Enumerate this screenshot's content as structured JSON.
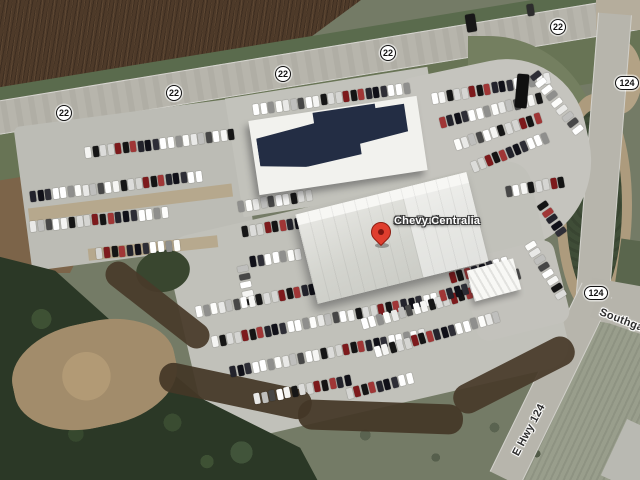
{
  "map": {
    "type": "satellite-view",
    "place": {
      "pin_label_line1": "Jim Butler",
      "pin_label_line2": "Chevy Centralia"
    },
    "road_labels": {
      "route22": "22",
      "route124": "124",
      "e_hwy": "E Hwy 124",
      "southgate": "Southgate"
    },
    "shields_22": [
      {
        "x": 64,
        "y": 113
      },
      {
        "x": 174,
        "y": 93
      },
      {
        "x": 283,
        "y": 74
      },
      {
        "x": 388,
        "y": 53
      },
      {
        "x": 558,
        "y": 27
      }
    ],
    "shields_124": [
      {
        "x": 627,
        "y": 83
      },
      {
        "x": 596,
        "y": 293
      }
    ],
    "colors": {
      "pin_red": "#df3e2e",
      "place_label_text": "#ffffff",
      "road_label_text": "#2e2e2e",
      "road_surface": "#b7b5ac",
      "parking_lot": "#c1c1ba",
      "plowed_field": "#4e3a29",
      "trees": "#2b3826",
      "grass": "#747b66",
      "pond": "#3f4d37",
      "dirt": "#a28c6b",
      "building_roof_white": "#eeeeea",
      "building_roof_dark": "#232d44"
    },
    "car_palette": [
      "#f5f5f3",
      "#141414",
      "#ffffff",
      "#bfbfbd",
      "#dcdcda",
      "#23232c",
      "#8f8f8d",
      "#ffffff",
      "#7d1a1c",
      "#2e2e36",
      "#e9e9e7",
      "#161616",
      "#a03636",
      "#ffffff",
      "#474747",
      "#d5d5d2",
      "#101018",
      "#fdfdfb"
    ],
    "car_rows": [
      {
        "x": 85,
        "y": 147,
        "n": 20,
        "sp": 7.6,
        "ang": -7
      },
      {
        "x": 30,
        "y": 191,
        "n": 23,
        "sp": 7.6,
        "ang": -7
      },
      {
        "x": 30,
        "y": 221,
        "n": 18,
        "sp": 7.8,
        "ang": -6
      },
      {
        "x": 96,
        "y": 248,
        "n": 11,
        "sp": 7.8,
        "ang": -6
      },
      {
        "x": 253,
        "y": 104,
        "n": 21,
        "sp": 7.6,
        "ang": -8
      },
      {
        "x": 432,
        "y": 93,
        "n": 16,
        "sp": 7.6,
        "ang": -10
      },
      {
        "x": 440,
        "y": 117,
        "n": 14,
        "sp": 7.6,
        "ang": -14
      },
      {
        "x": 455,
        "y": 139,
        "n": 12,
        "sp": 7.6,
        "ang": -18
      },
      {
        "x": 472,
        "y": 161,
        "n": 11,
        "sp": 7.6,
        "ang": -22
      },
      {
        "x": 533,
        "y": 70,
        "n": 9,
        "sp": 8.6,
        "ang": 52
      },
      {
        "x": 506,
        "y": 186,
        "n": 8,
        "sp": 7.6,
        "ang": -10
      },
      {
        "x": 540,
        "y": 200,
        "n": 5,
        "sp": 8,
        "ang": 55
      },
      {
        "x": 238,
        "y": 201,
        "n": 10,
        "sp": 7.6,
        "ang": -9
      },
      {
        "x": 242,
        "y": 226,
        "n": 8,
        "sp": 7.6,
        "ang": -9
      },
      {
        "x": 250,
        "y": 256,
        "n": 7,
        "sp": 7.6,
        "ang": -9
      },
      {
        "x": 240,
        "y": 263,
        "n": 5,
        "sp": 8.4,
        "ang": 78
      },
      {
        "x": 450,
        "y": 272,
        "n": 8,
        "sp": 7.7,
        "ang": -16
      },
      {
        "x": 196,
        "y": 306,
        "n": 30,
        "sp": 7.7,
        "ang": -11
      },
      {
        "x": 212,
        "y": 336,
        "n": 30,
        "sp": 7.7,
        "ang": -11
      },
      {
        "x": 230,
        "y": 366,
        "n": 26,
        "sp": 7.7,
        "ang": -11
      },
      {
        "x": 254,
        "y": 393,
        "n": 13,
        "sp": 7.7,
        "ang": -11
      },
      {
        "x": 347,
        "y": 388,
        "n": 9,
        "sp": 7.7,
        "ang": -14
      },
      {
        "x": 362,
        "y": 318,
        "n": 19,
        "sp": 7.7,
        "ang": -16
      },
      {
        "x": 375,
        "y": 346,
        "n": 17,
        "sp": 7.7,
        "ang": -16
      },
      {
        "x": 440,
        "y": 290,
        "n": 11,
        "sp": 7.7,
        "ang": -16
      },
      {
        "x": 528,
        "y": 240,
        "n": 8,
        "sp": 8.2,
        "ang": 58
      }
    ],
    "road_vehicles": [
      {
        "x": 466,
        "y": 14,
        "w": 10,
        "h": 18,
        "ang": -9,
        "color": "#181818"
      },
      {
        "x": 527,
        "y": 4,
        "w": 7,
        "h": 12,
        "ang": -9,
        "color": "#2d2d2d"
      },
      {
        "x": 516,
        "y": 74,
        "w": 12,
        "h": 34,
        "ang": 5,
        "color": "#101010"
      }
    ]
  }
}
